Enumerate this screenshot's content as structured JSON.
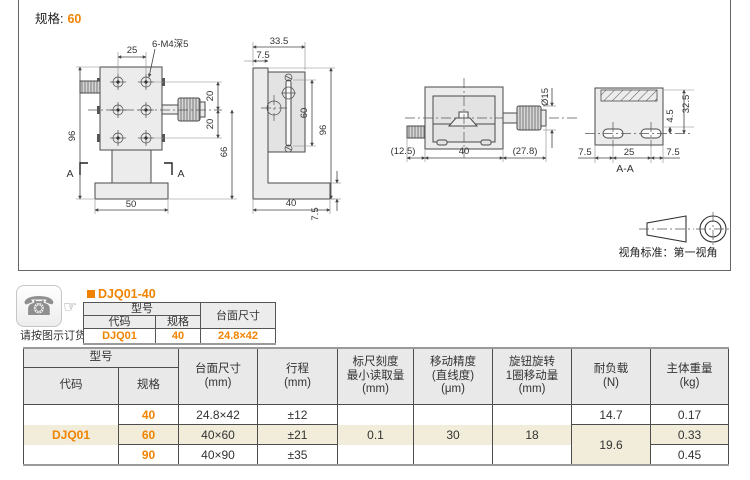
{
  "drawing": {
    "spec_label": "规格:",
    "spec_value": "60",
    "view_note": "视角标准：第一视角",
    "front": {
      "dim_width_top": "25",
      "thread_note": "6-M4深5",
      "dim_height": "96",
      "dim_pitch_upper": "20",
      "dim_pitch_lower": "20",
      "dim_knob_height": "66",
      "dim_base": "50",
      "section_mark": "A"
    },
    "side": {
      "dim_depth": "33.5",
      "dim_offset": "7.5",
      "dim_travel": "60",
      "dim_height": "96",
      "dim_base": "40",
      "dim_base_thickness": "7.5"
    },
    "top": {
      "dim_left": "(12.5)",
      "dim_body": "40",
      "dim_knob": "(27.8)",
      "dim_dia": "Ø15"
    },
    "section": {
      "dim_left": "7.5",
      "dim_center": "25",
      "dim_right": "7.5",
      "dim_slot": "4.5",
      "dim_height": "32.5",
      "label": "A-A"
    }
  },
  "order": {
    "phone_icon": "phone-icon",
    "pointer_icon": "pointing-hand-icon",
    "note": "请按图示订货",
    "product_code": "DJQ01-40",
    "mini_table": {
      "header_model": "型号",
      "header_size": "台面尺寸",
      "col_code": "代码",
      "col_spec": "规格",
      "code": "DJQ01",
      "spec": "40",
      "size": "24.8×42"
    }
  },
  "spec_table": {
    "header": {
      "model": "型号",
      "code": "代码",
      "spec": "规格",
      "cols": [
        "台面尺寸\n(mm)",
        "行程\n(mm)",
        "标尺刻度\n最小读取量\n(mm)",
        "移动精度\n(直线度)\n(μm)",
        "旋钮旋转\n1圈移动量\n(mm)",
        "耐负载\n(N)",
        "主体重量\n(kg)"
      ]
    },
    "rows": [
      {
        "code": "DJQ01",
        "spec": "40",
        "size": "24.8×42",
        "travel": "±12",
        "scale": "0.1",
        "accuracy": "30",
        "per_turn": "18",
        "load": "14.7",
        "weight": "0.17"
      },
      {
        "spec": "60",
        "size": "40×60",
        "travel": "±21",
        "load": "19.6",
        "weight": "0.33"
      },
      {
        "spec": "90",
        "size": "40×90",
        "travel": "±35",
        "weight": "0.45"
      }
    ]
  },
  "colors": {
    "accent_orange": "#F08300",
    "row_highlight": "#f1edda",
    "header_gray": "#e9e9e9"
  }
}
